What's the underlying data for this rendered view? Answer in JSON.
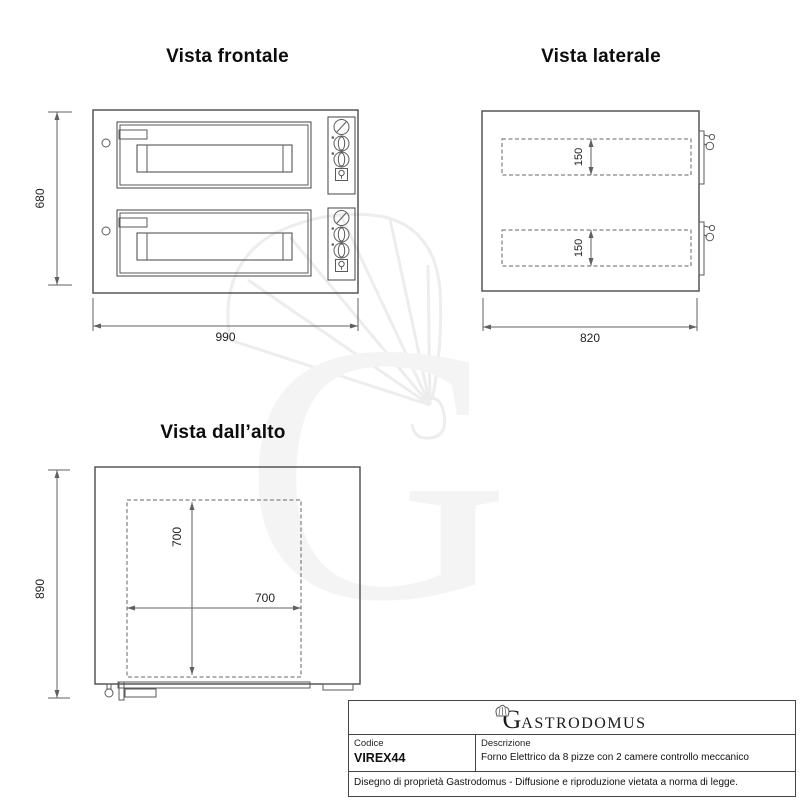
{
  "views": {
    "front": {
      "title": "Vista frontale",
      "height_mm": "680",
      "width_mm": "990"
    },
    "side": {
      "title": "Vista laterale",
      "chamber_top_mm": "150",
      "chamber_bottom_mm": "150",
      "depth_mm": "820"
    },
    "top": {
      "title": "Vista dall’alto",
      "depth_mm": "890",
      "inner_depth_mm": "700",
      "inner_width_mm": "700"
    }
  },
  "watermark": {
    "letter": "G"
  },
  "title_block": {
    "brand_initial": "G",
    "brand_rest": "ASTRODOMUS",
    "code_label": "Codice",
    "code_value": "VIREX44",
    "description_label": "Descrizione",
    "description_value": "Forno Elettrico da 8 pizze con 2 camere controllo meccanico",
    "legal": "Disegno di proprietà Gastrodomus - Diffusione e riproduzione vietata a norma di legge."
  }
}
